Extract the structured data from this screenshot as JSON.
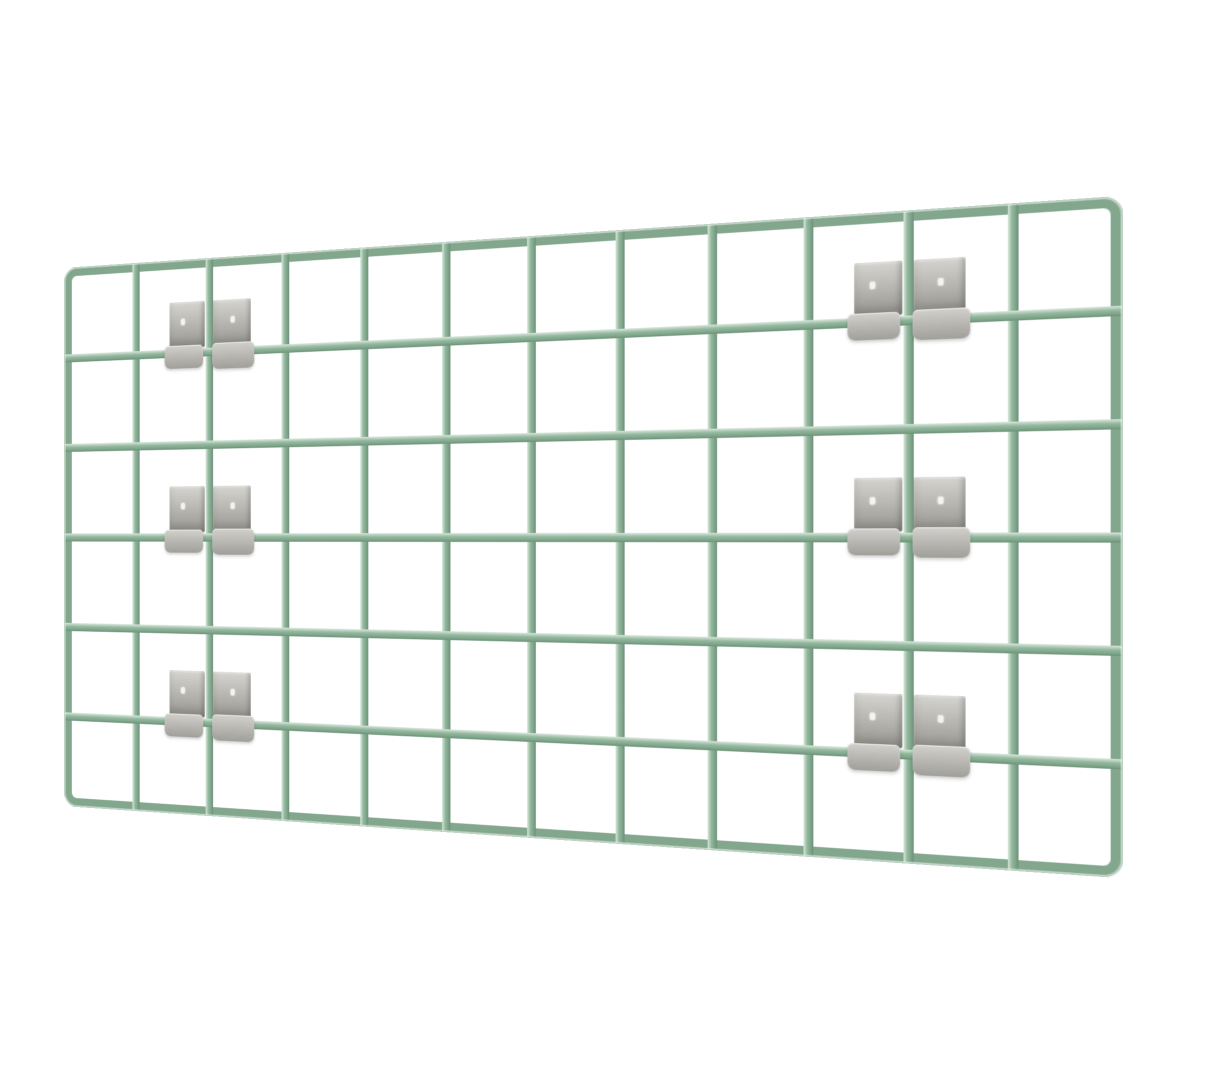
{
  "scene": {
    "type": "product-photo",
    "subject": "sage green wire grid panel with six pairs of gray mounting clips, shown in perspective",
    "background_color": "#ffffff"
  },
  "panel": {
    "rows": 6,
    "columns": 12,
    "wire_thickness_px": 9,
    "colors": {
      "wire_highlight": "#d9e8dc",
      "wire_mid": "#93b79e",
      "wire_base": "#7fa68b",
      "wire_shadow": "#6b9077",
      "frame": "#83a78d"
    }
  },
  "brackets": {
    "count": 6,
    "clips_per_bracket": 2,
    "colors": {
      "plate_light": "#d6d4cf",
      "plate_mid": "#b4b2ad",
      "plate_dark": "#97958f",
      "hook_light": "#d2d0cb",
      "hook_mid": "#b0aea9",
      "dot": "#f4f3f0"
    },
    "positions": [
      {
        "col_boundary": 2,
        "row_boundary": 1
      },
      {
        "col_boundary": 2,
        "row_boundary": 3
      },
      {
        "col_boundary": 2,
        "row_boundary": 5
      },
      {
        "col_boundary": 10,
        "row_boundary": 1
      },
      {
        "col_boundary": 10,
        "row_boundary": 3
      },
      {
        "col_boundary": 10,
        "row_boundary": 5
      }
    ]
  },
  "view": {
    "rotation_y_deg": -15.2,
    "perspective_px": 1200
  }
}
